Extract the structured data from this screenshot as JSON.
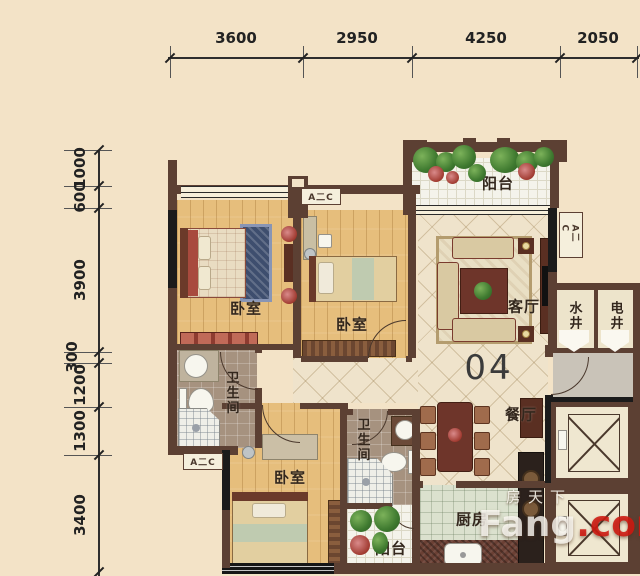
{
  "dimensions": {
    "top": [
      "3600",
      "2950",
      "4250",
      "2050"
    ],
    "left": [
      "1000",
      "600",
      "3900",
      "300",
      "1200",
      "1300",
      "3400"
    ]
  },
  "unit_number": "04",
  "rooms": {
    "bedroom_top_left": "卧室",
    "bedroom_top_middle": "卧室",
    "bedroom_bottom": "卧室",
    "living_room": "客厅",
    "dining_room": "餐厅",
    "kitchen": "厨房",
    "bathroom_1": "卫生间",
    "bathroom_2": "卫生间",
    "balcony_top": "阳台",
    "balcony_bottom": "阳台",
    "water_shaft": "水井",
    "electric_shaft": "电井"
  },
  "labels": {
    "ac_unit": "A二C"
  },
  "watermark": {
    "site_cn": "房天下",
    "brand": "Fang",
    "brand_suffix": ".com"
  },
  "colors": {
    "background": "#F3E3C7",
    "wall": "#5C4033",
    "wall_dark": "#1B1B1B",
    "wood_floor": "#E6BE7C",
    "tile_floor": "#EFE3CB",
    "watermark_red": "#CE1810"
  }
}
